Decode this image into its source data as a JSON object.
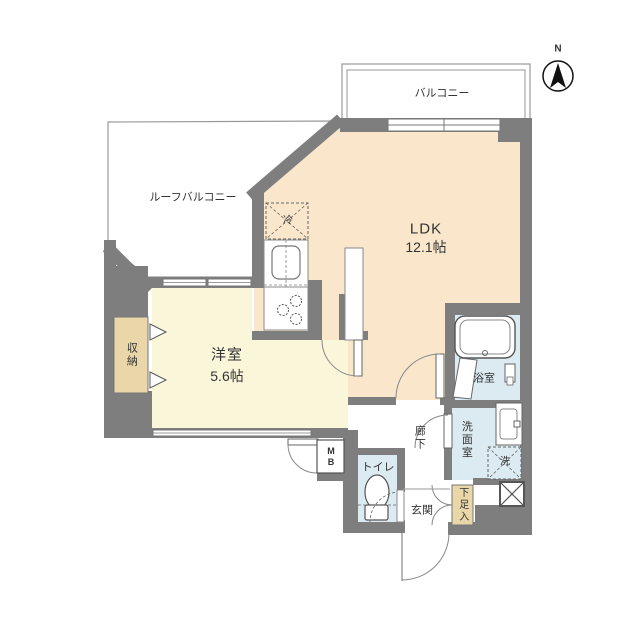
{
  "plan": {
    "compass_label": "N",
    "rooms": {
      "balcony": {
        "label": "バルコニー"
      },
      "roof_balcony": {
        "label": "ルーフバルコニー"
      },
      "ldk": {
        "label": "LDK",
        "size": "12.1帖"
      },
      "western_room": {
        "label": "洋室",
        "size": "5.6帖"
      },
      "storage": {
        "label": "収納"
      },
      "bathroom": {
        "label": "浴室"
      },
      "washroom": {
        "label": "洗面室"
      },
      "toilet": {
        "label": "トイレ"
      },
      "hallway": {
        "label": "廊下"
      },
      "entrance": {
        "label": "玄関"
      },
      "shoe_storage": {
        "label": "下足入"
      },
      "meter_box": {
        "line1": "M",
        "line2": "B"
      }
    },
    "fixtures": {
      "refrigerator": "冷",
      "washer": "洗"
    },
    "colors": {
      "wall": "#7e7e7e",
      "ldk_floor": "#fae7cb",
      "western_floor": "#faf6da",
      "closet": "#e9d7a9",
      "wet_room": "#dcebf2",
      "outline": "#999999"
    }
  }
}
